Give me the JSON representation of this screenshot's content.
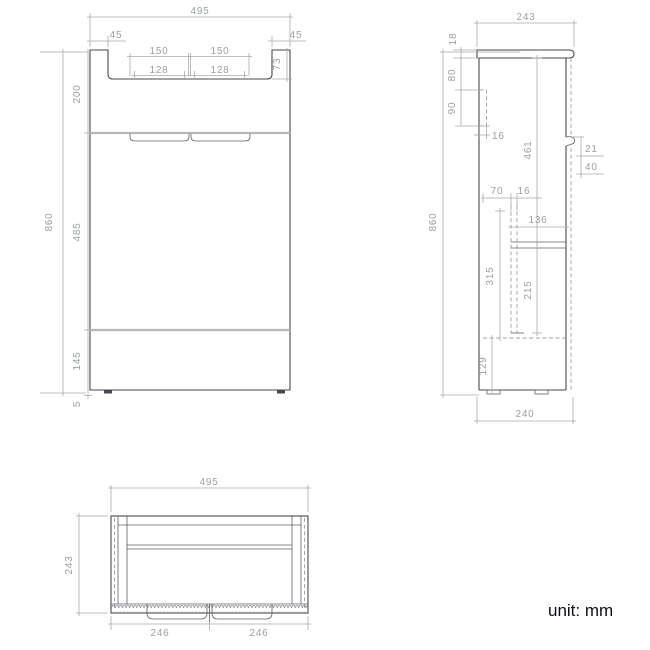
{
  "footer": {
    "unit_label": "unit: mm"
  },
  "front_view": {
    "overall_width": "495",
    "side_panel_left": "45",
    "side_panel_right": "45",
    "recess_outer_left": "150",
    "recess_outer_right": "150",
    "recess_inner_left": "128",
    "recess_inner_right": "128",
    "top_recess_depth": "73",
    "top_section_height": "200",
    "overall_height": "860",
    "middle_section_height": "485",
    "bottom_section_height": "145",
    "foot_height": "5"
  },
  "side_view": {
    "overall_depth": "243",
    "countertop_thickness": "18",
    "bracket_top_offset": "80",
    "bracket_height": "90",
    "bracket_width": "16",
    "overall_height": "860",
    "door_height": "461",
    "handle_lip_depth": "21",
    "handle_zone_height": "40",
    "rail_back_offset": "70",
    "rail_width": "16",
    "shelf_depth": "136",
    "rail_length": "315",
    "shelf_to_rail": "215",
    "base_height": "129",
    "bottom_depth": "240"
  },
  "top_view": {
    "overall_width": "495",
    "overall_depth": "243",
    "door_left_width": "246",
    "door_right_width": "246"
  }
}
